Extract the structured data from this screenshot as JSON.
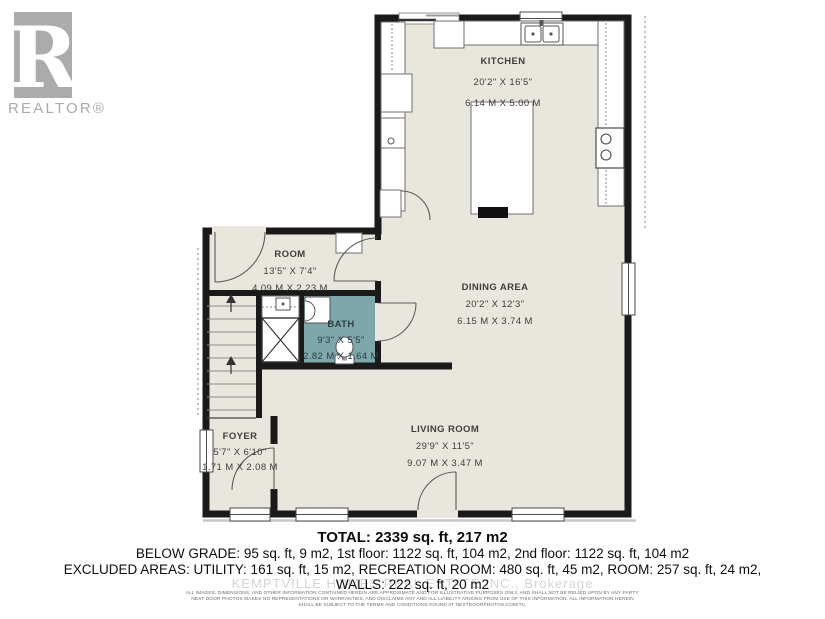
{
  "logo": {
    "letter": "R",
    "brand": "REALTOR®"
  },
  "plan": {
    "rooms": [
      {
        "id": "kitchen",
        "name": "KITCHEN",
        "dim_ft": "20'2\" X 16'5\"",
        "dim_m": "6.14 M X 5.00 M"
      },
      {
        "id": "dining",
        "name": "DINING AREA",
        "dim_ft": "20'2\" X 12'3\"",
        "dim_m": "6.15 M X 3.74 M"
      },
      {
        "id": "living",
        "name": "LIVING ROOM",
        "dim_ft": "29'9\" X 11'5\"",
        "dim_m": "9.07 M X 3.47 M"
      },
      {
        "id": "room",
        "name": "ROOM",
        "dim_ft": "13'5\" X 7'4\"",
        "dim_m": "4.09 M X 2.23 M"
      },
      {
        "id": "bath",
        "name": "BATH",
        "dim_ft": "9'3\" X 5'5\"",
        "dim_m": "2.82 M X 1.64 M"
      },
      {
        "id": "foyer",
        "name": "FOYER",
        "dim_ft": "5'7\" X 6'10\"",
        "dim_m": "1.71 M X 2.08 M"
      }
    ],
    "colors": {
      "floor": "#e9e7dd",
      "bath_fill": "#7da7ab",
      "wall": "#1a1a1a",
      "logo_gray": "#ababab"
    }
  },
  "summary": {
    "total": "TOTAL: 2339 sq. ft, 217 m2",
    "line2": "BELOW GRADE: 95 sq. ft, 9 m2, 1st floor: 1122 sq. ft, 104 m2, 2nd floor: 1122 sq. ft, 104 m2",
    "line3": "EXCLUDED AREAS: UTILITY: 161 sq. ft, 15 m2, RECREATION ROOM: 480 sq. ft, 45 m2, ROOM: 257 sq. ft, 24 m2,",
    "line4": "WALLS: 222 sq. ft, 20 m2"
  },
  "watermark": "KEMPTVILLE HOMES REAL ESTATE INC., Brokerage",
  "disclaimer": {
    "line1": "ALL IMAGES, DIMENSIONS, AND OTHER INFORMATION CONTAINED HEREIN ARE APPROXIMATE AND FOR ILLUSTRATIVE PURPOSES ONLY, AND SHALL NOT BE RELIED UPON BY ANY PARTY.",
    "line2": "NEXT DOOR PHOTOS MAKES NO REPRESENTATIONS OR WARRANTIES, AND DISCLAIMS ANY AND ALL LIABILITY ARISING FROM USE OF THIS INFORMATION. ALL INFORMATION HEREIN",
    "line3": "SHALL BE SUBJECT TO THE TERMS AND CONDITIONS FOUND AT NEXTDOORPHOTOS.COM/TC."
  }
}
